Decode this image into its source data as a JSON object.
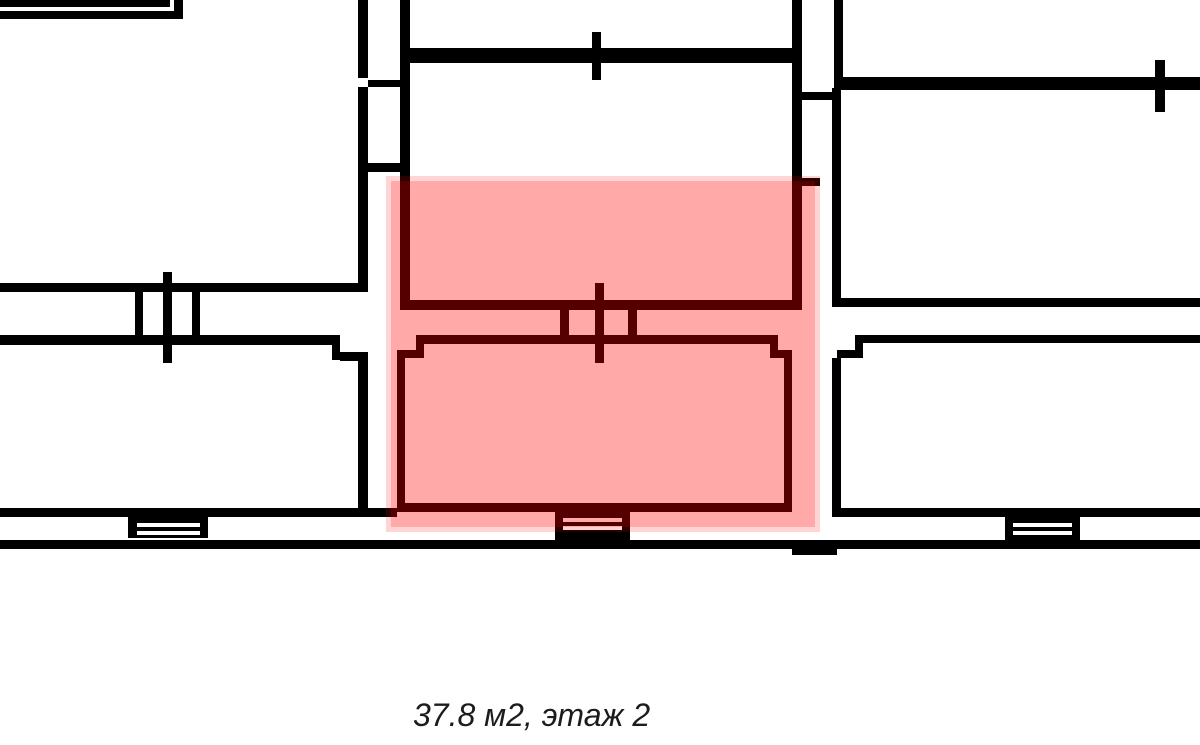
{
  "page": {
    "background_color": "#ffffff"
  },
  "floor_plan": {
    "wall_color": "#000000",
    "window_slit_color": "#ffffff",
    "highlight": {
      "color": "#ff0002",
      "outer": [
        386,
        176,
        434,
        356
      ],
      "outer_opacity": 0.17,
      "core": [
        391,
        181,
        424,
        346
      ],
      "core_opacity": 0.2
    },
    "walls": [
      [
        0,
        0,
        170,
        7
      ],
      [
        0,
        11,
        183,
        8
      ],
      [
        174,
        0,
        9,
        19
      ],
      [
        358,
        0,
        10,
        78
      ],
      [
        358,
        87,
        10,
        205
      ],
      [
        368,
        80,
        32,
        7
      ],
      [
        368,
        163,
        42,
        9
      ],
      [
        400,
        0,
        10,
        310
      ],
      [
        400,
        48,
        402,
        15
      ],
      [
        592,
        32,
        9,
        48
      ],
      [
        792,
        0,
        10,
        310
      ],
      [
        400,
        300,
        402,
        10
      ],
      [
        792,
        178,
        28,
        8
      ],
      [
        834,
        0,
        9,
        90
      ],
      [
        834,
        77,
        366,
        13
      ],
      [
        1155,
        60,
        10,
        52
      ],
      [
        802,
        92,
        32,
        8
      ],
      [
        832,
        88,
        9,
        214
      ],
      [
        560,
        310,
        9,
        25
      ],
      [
        595,
        283,
        9,
        80
      ],
      [
        628,
        310,
        9,
        25
      ],
      [
        424,
        335,
        346,
        9
      ],
      [
        416,
        335,
        8,
        23
      ],
      [
        397,
        350,
        27,
        8
      ],
      [
        770,
        335,
        8,
        23
      ],
      [
        770,
        350,
        22,
        8
      ],
      [
        397,
        358,
        8,
        154
      ],
      [
        784,
        357,
        8,
        155
      ],
      [
        397,
        503,
        395,
        9
      ],
      [
        0,
        283,
        368,
        9
      ],
      [
        0,
        335,
        340,
        10
      ],
      [
        332,
        345,
        8,
        15
      ],
      [
        340,
        352,
        28,
        9
      ],
      [
        358,
        360,
        10,
        150
      ],
      [
        135,
        292,
        8,
        43
      ],
      [
        163,
        272,
        9,
        91
      ],
      [
        192,
        292,
        8,
        43
      ],
      [
        832,
        298,
        368,
        9
      ],
      [
        863,
        335,
        337,
        8
      ],
      [
        855,
        335,
        8,
        23
      ],
      [
        837,
        350,
        26,
        8
      ],
      [
        832,
        358,
        9,
        159
      ],
      [
        0,
        508,
        397,
        9
      ],
      [
        832,
        508,
        368,
        9
      ],
      [
        0,
        540,
        1200,
        9
      ],
      [
        792,
        547,
        45,
        8
      ]
    ],
    "windows": [
      {
        "block": [
          128,
          517,
          80,
          21
        ],
        "slits": [
          [
            137,
            523,
            63,
            4
          ],
          [
            137,
            531,
            63,
            4
          ]
        ]
      },
      {
        "block": [
          555,
          512,
          75,
          28
        ],
        "slits": [
          [
            563,
            518,
            59,
            4
          ],
          [
            563,
            526,
            59,
            4
          ]
        ]
      },
      {
        "block": [
          1005,
          516,
          75,
          24
        ],
        "slits": [
          [
            1013,
            523,
            59,
            4
          ],
          [
            1013,
            531,
            59,
            4
          ]
        ]
      }
    ],
    "caption": {
      "text": "37.8 м2, этаж 2",
      "area_value": "37.8 м2",
      "floor_label": "этаж 2",
      "color": "#1c1c1c"
    }
  }
}
